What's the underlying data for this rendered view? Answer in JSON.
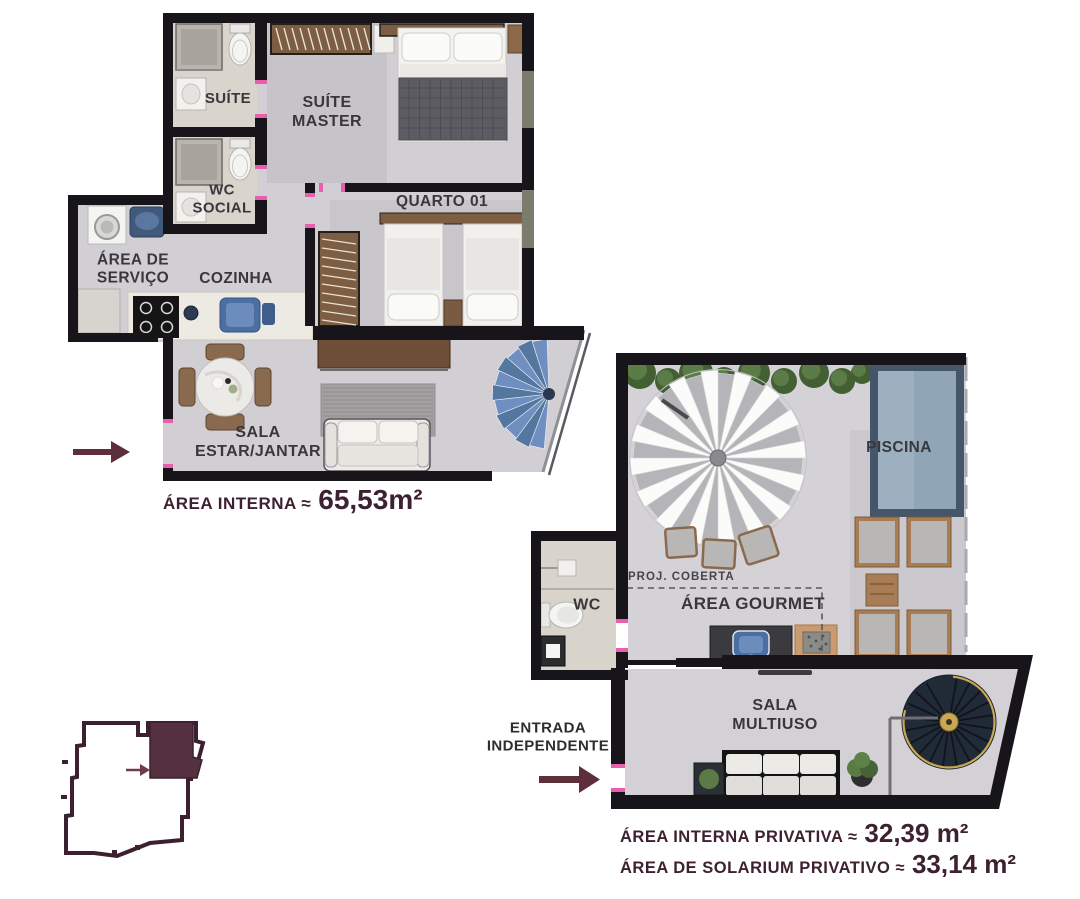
{
  "plan1": {
    "labels": {
      "suite": "SUÍTE",
      "suite_master": [
        "SUÍTE",
        "MASTER"
      ],
      "wc_social": [
        "WC",
        "SOCIAL"
      ],
      "quarto": "QUARTO 01",
      "area_servico": [
        "ÁREA DE",
        "SERVIÇO"
      ],
      "cozinha": "COZINHA",
      "sala": [
        "SALA",
        "ESTAR/JANTAR"
      ]
    },
    "area": {
      "label": "ÁREA INTERNA ≈",
      "value": "65,53m²"
    }
  },
  "plan2": {
    "labels": {
      "piscina": "PISCINA",
      "proj_coberta": "PROJ. COBERTA",
      "area_gourmet": "ÁREA GOURMET",
      "wc": "WC",
      "sala_multiuso": [
        "SALA",
        "MULTIUSO"
      ],
      "entrada": [
        "ENTRADA",
        "INDEPENDENTE"
      ]
    },
    "areas": [
      {
        "label": "ÁREA INTERNA PRIVATIVA ≈",
        "value": "32,39 m²"
      },
      {
        "label": "ÁREA DE SOLARIUM PRIVATIVO ≈",
        "value": "33,14 m²"
      }
    ]
  },
  "icons": {
    "entry_arrow_plan1": "right-arrow-icon",
    "entry_arrow_plan2": "right-arrow-icon",
    "keyplan_unit_arrow": "right-arrow-icon"
  },
  "colors": {
    "accent_maroon": "#5c2f3a",
    "text_dark": "#3a373c",
    "area_text": "#3e2130",
    "wall": "#17141a",
    "floor": "#d1cfd4",
    "floor2": "#d4d2d6",
    "bath_floor": "#d9d5cc",
    "window": "#7b7b6e",
    "door_mark": "#e95fae",
    "wood": "#7d5e43",
    "wood_dark": "#6e4e37",
    "pool_border": "#45566b",
    "pool_water": "#90a5b6",
    "pool_water_light": "#9cb0bf",
    "stair_blue_a": "#6f8fc0",
    "stair_blue_b": "#53779f",
    "stair_dark": "#212a37",
    "gold": "#c9a855",
    "umbrella_white": "#fbfbfa",
    "umbrella_gray": "#b5b4b8",
    "hedge_dark": "#426033",
    "hedge_light": "#5e8049",
    "sink_blue": "#4c6fa3",
    "keyplan_outline": "#3b2130",
    "keyplan_unit": "#55303e"
  }
}
